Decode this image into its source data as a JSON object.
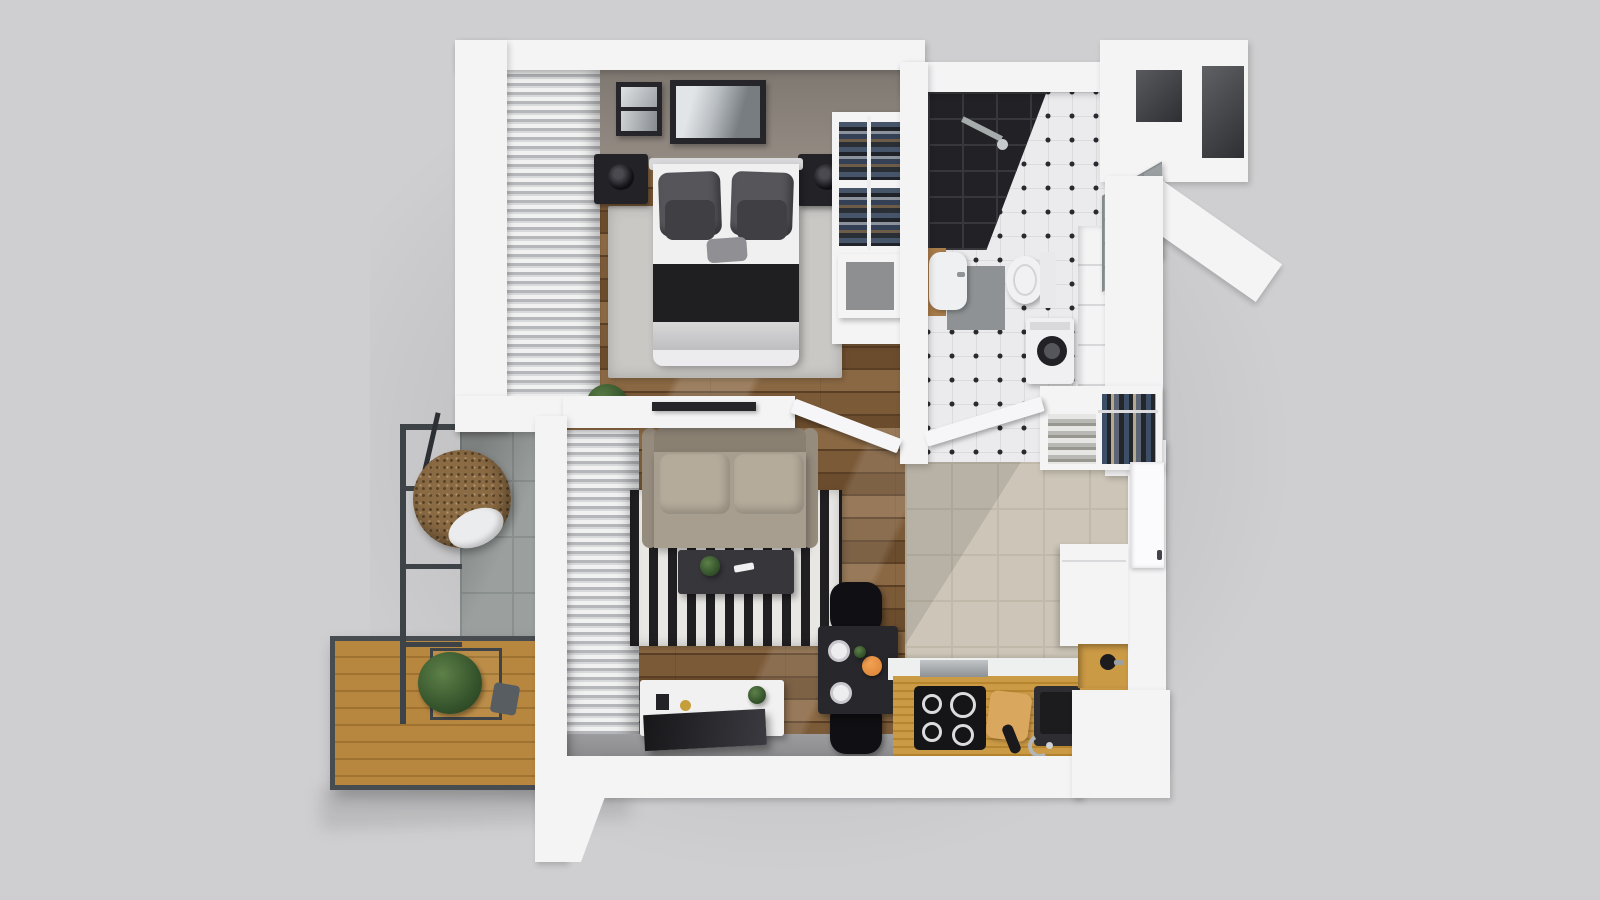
{
  "meta": {
    "description": "3D top-down architectural render of a one-bedroom apartment floor plan on a plain light-gray background",
    "view": "bird's-eye 3D floorplan",
    "canvas": {
      "width": 1600,
      "height": 900
    }
  },
  "palette": {
    "bg": "#cfcfd1",
    "wall": "#f4f4f5",
    "taupe_a": "#7f7871",
    "taupe_b": "#958c84",
    "wood_light": "#8a6843",
    "wood_mid": "#7b5a38",
    "wood_dark": "#6b4c2d",
    "wood_seam": "#5a3f24",
    "rug": "#c9c8c5",
    "stripe_dark": "#202023",
    "stripe_light": "#e8e7e4",
    "tile_beige": "#cdc6b8",
    "tile_line": "#c1baab",
    "bath_tile": "#ebebed",
    "bath_dot": "#2a2a2e",
    "shower": "#222226",
    "deck_a": "#b8873f",
    "deck_b": "#9f7230",
    "metal": "#3e4348",
    "concrete": "#9ba09e",
    "concrete_line": "#8a908e",
    "sofa": "#a89e8f",
    "sofa_light": "#b5ab9b",
    "sofa_dark": "#8a8072",
    "bed": "#f0f0f1",
    "pillow": "#55555a",
    "blanket": "#1f1f22",
    "table_black": "#28282c",
    "chair_black": "#101014",
    "counter_wood_a": "#cb9a45",
    "counter_wood_b": "#b8852f",
    "plant_a": "#5d8048",
    "plant_b": "#243c1e",
    "rattan": "#8b6b44",
    "orange": "#e08a3c",
    "gold": "#c59f3b",
    "chrome": "#b3b7ba"
  },
  "scene": {
    "type": "3d-floorplan-render",
    "rooms": [
      {
        "name": "bedroom",
        "furniture": [
          "double-bed",
          "gray-area-rug",
          "nightstand-left",
          "nightstand-right",
          "table-lamps",
          "wall-art-frames",
          "window-blinds",
          "open-wardrobe-clothes",
          "dresser",
          "potted-plant",
          "console-shelf"
        ]
      },
      {
        "name": "bathroom",
        "furniture": [
          "dark-tiled-walk-in-shower",
          "shower-head",
          "sink-vanity",
          "toilet",
          "washing-machine",
          "bath-mat",
          "tall-storage-cabinet",
          "open-door"
        ]
      },
      {
        "name": "hallway-kitchen",
        "furniture": [
          "entry-door",
          "closet-towels",
          "closet-hanging-clothes",
          "tall-cabinet",
          "wood-niche-with-bottle",
          "kitchen-counter-wood-top",
          "induction-cooktop",
          "kitchen-sink",
          "cutting-board",
          "utensils"
        ]
      },
      {
        "name": "dining-nook",
        "furniture": [
          "black-dining-table",
          "two-black-chairs",
          "plates",
          "orange-fruit-bowl",
          "flower-decor"
        ]
      },
      {
        "name": "living-room",
        "furniture": [
          "beige-sofa",
          "black-white-striped-rug",
          "dark-coffee-table",
          "tv-sideboard",
          "wall-mounted-tv",
          "window-blinds",
          "potted-plant"
        ]
      },
      {
        "name": "balcony",
        "furniture": [
          "hanging-rattan-egg-chair",
          "white-cushion",
          "wood-deck",
          "dark-metal-railing",
          "cube-planter-with-plant",
          "concrete-tile-wall",
          "watering-can"
        ]
      }
    ],
    "exterior": [
      "top-right-wall-niches",
      "slanted-outer-wall",
      "tiled-wall-ledge",
      "soft-ground-shadows"
    ]
  }
}
